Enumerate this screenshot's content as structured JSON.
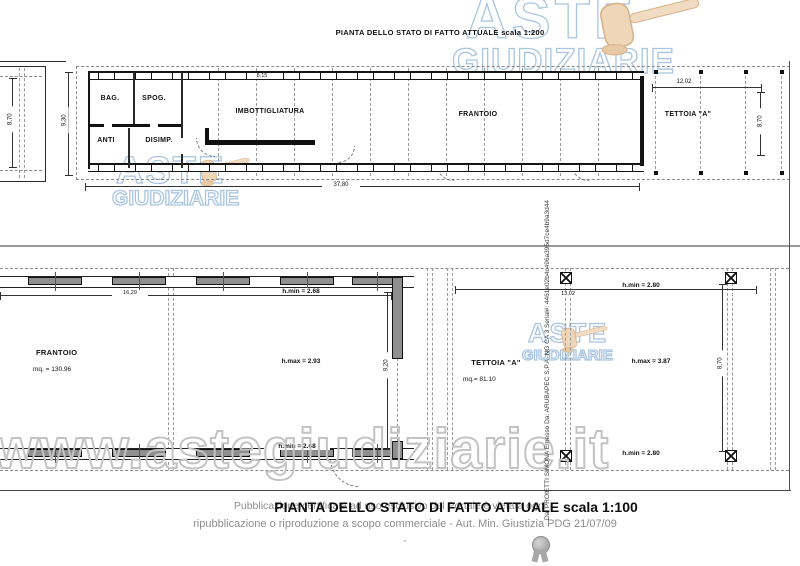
{
  "colors": {
    "brand_blue_stroke": "#a9c5e2",
    "url_watermark_gray": "#c3c3c3",
    "gavel_tan": "#eed6b8",
    "pier_gray": "#8f8f8f"
  },
  "watermark": {
    "brand_top": "ASTE",
    "brand_bottom": "GIUDIZIARIE",
    "url": "www.astegiudiziarie.it"
  },
  "upper_plan": {
    "title": "PIANTA DELLO STATO DI FATTO ATTUALE scala 1:200",
    "rooms": {
      "bag": "BAG.",
      "spog": "SPOG.",
      "anti": "ANTI",
      "disimp": "DISIMP.",
      "imbottigliatura": "IMBOTTIGLIATURA",
      "frantoio": "FRANTOIO",
      "tettoia": "TETTOIA \"A\""
    },
    "dims": {
      "left_structure_height": "8,70",
      "building_height": "9,30",
      "top_width": "8,15",
      "tettoia_width": "12,02",
      "tettoia_height": "8,70",
      "total_width": "37,80"
    }
  },
  "lower_plan": {
    "frantoio": {
      "name": "FRANTOIO",
      "area": "mq. = 130.96",
      "width": "16,29",
      "h_min_top": "h.min = 2.68",
      "h_max": "h.max = 2.93",
      "height": "9,20",
      "h_min_bottom": "h.min = 2.68"
    },
    "tettoia": {
      "name": "TETTOIA \"A\"",
      "area": "mq.= 81.10",
      "width": "13,02",
      "h_min_top": "h.min = 2.80",
      "h_max": "h.max = 3.87",
      "height": "8,70",
      "h_min_bottom": "h.min = 2.80"
    }
  },
  "signature": {
    "vertical_text": "Da: PROIETTI SIMONA Emesso Da: ARUBAPEC S.P.A. NG CA 3 Serial#: 4461e02b4c496a395d7ce4b9a3d44"
  },
  "footer": {
    "title": "PIANTA DELLO STATO DI FATTO ATTUALE scala 1:100",
    "disclaimer1": "Pubblicazione certificata ad uso esclusivo del Portale è vietata ogni",
    "disclaimer2": "ripubblicazione o riproduzione a scopo commerciale - Aut. Min. Giustizia PDG 21/07/09",
    "dash": "-"
  }
}
